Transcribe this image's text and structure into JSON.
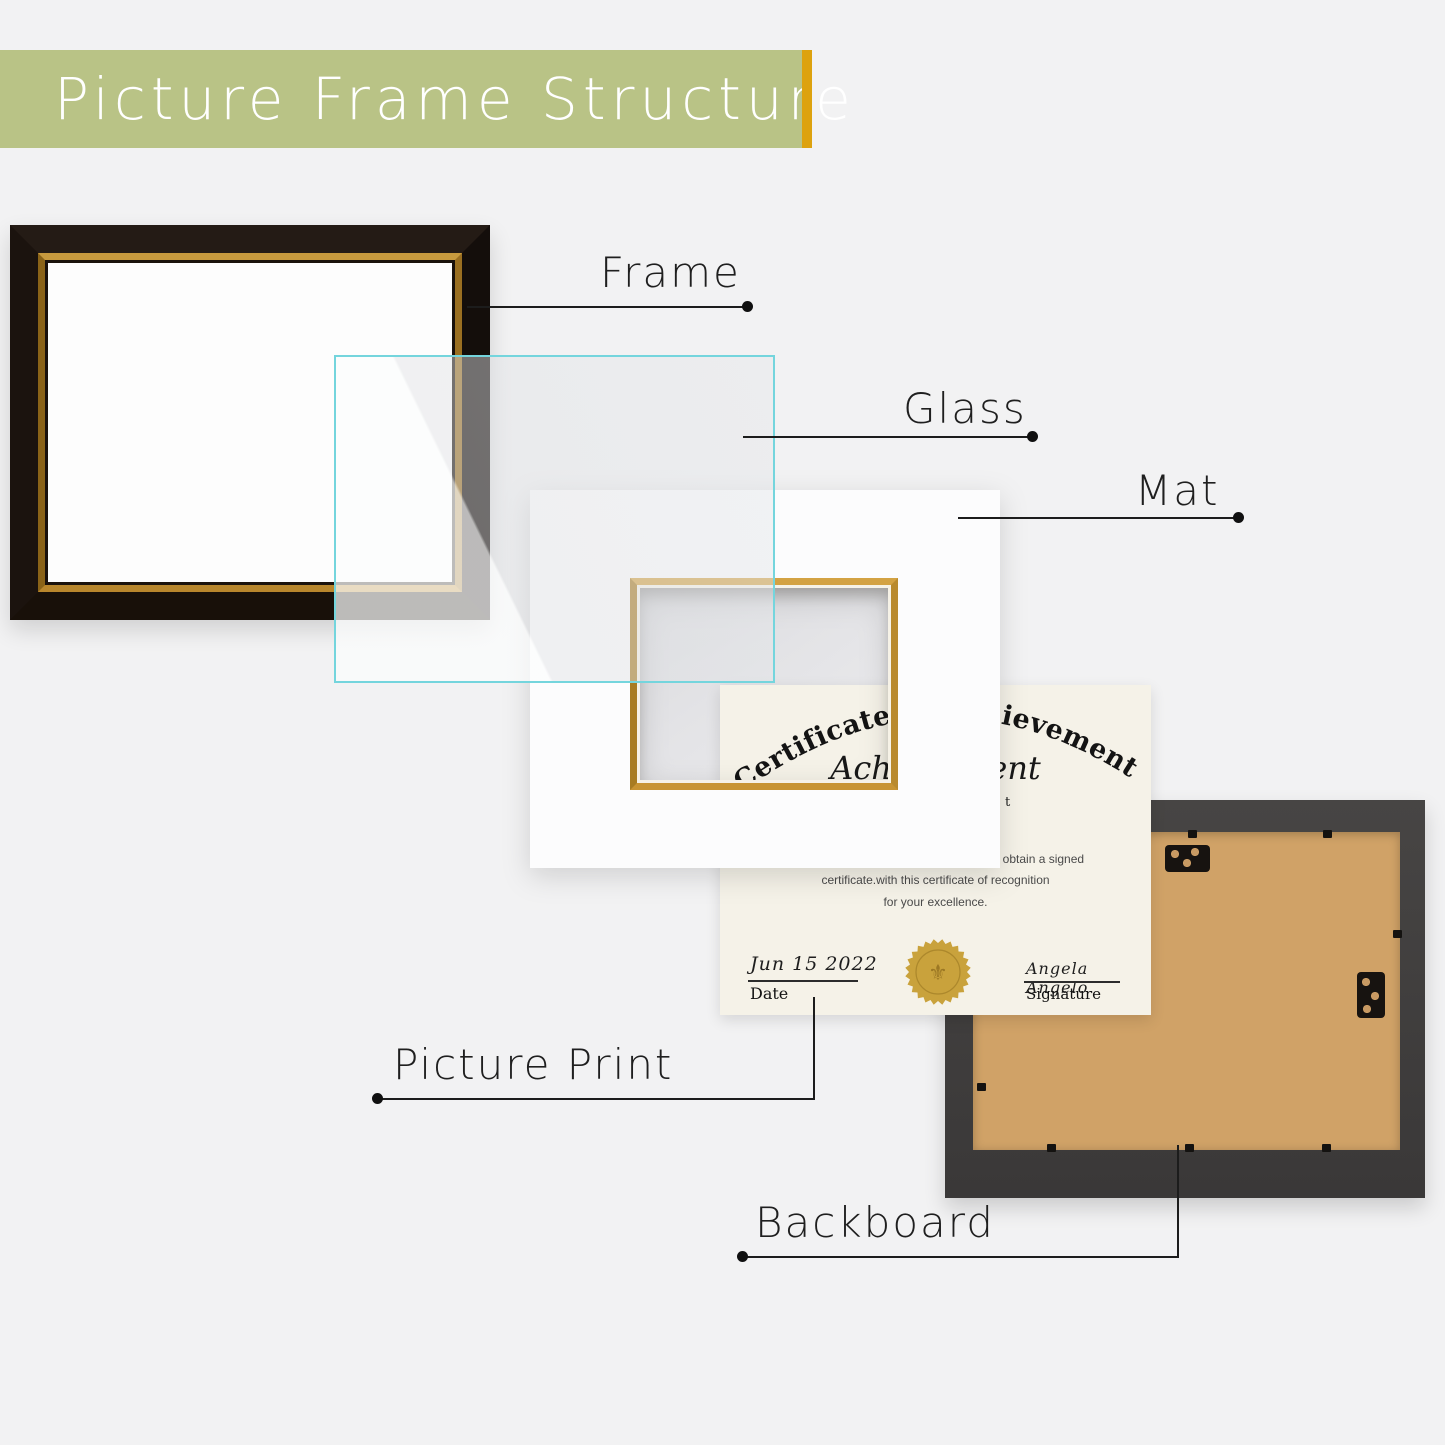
{
  "header": {
    "title": "Picture Frame Structure",
    "banner_color": "#b9c386",
    "accent_bar_color": "#dda20e",
    "title_color": "#ffffff"
  },
  "labels": {
    "frame": "Frame",
    "glass": "Glass",
    "mat": "Mat",
    "picture_print": "Picture Print",
    "backboard": "Backboard"
  },
  "certificate": {
    "arc_title": "Certificate of Achievement",
    "script_line": "Achievement",
    "small_fragment": "t",
    "body_lines": [
      "f obtain a signed",
      "certificate.with this certificate of recognition",
      "for your excellence."
    ],
    "date_value": "Jun 15 2022",
    "date_label": "Date",
    "signature_value": "Angela  Angelo",
    "signature_label": "Signature",
    "seal_icon": "fleur-de-lis-gold-seal",
    "seal_glyph": "⚜"
  },
  "colors": {
    "background": "#f2f2f3",
    "glass_cyan": "#74d5dd",
    "mat_window_gold": "#c89433",
    "frame_black": "#17110d",
    "frame_gold_trim": "#b8862c",
    "backboard_frame": "#413f3e",
    "backboard_wood": "#d0a267",
    "seal_gold": "#c9a23c",
    "leader_line": "#1c1c1c"
  }
}
